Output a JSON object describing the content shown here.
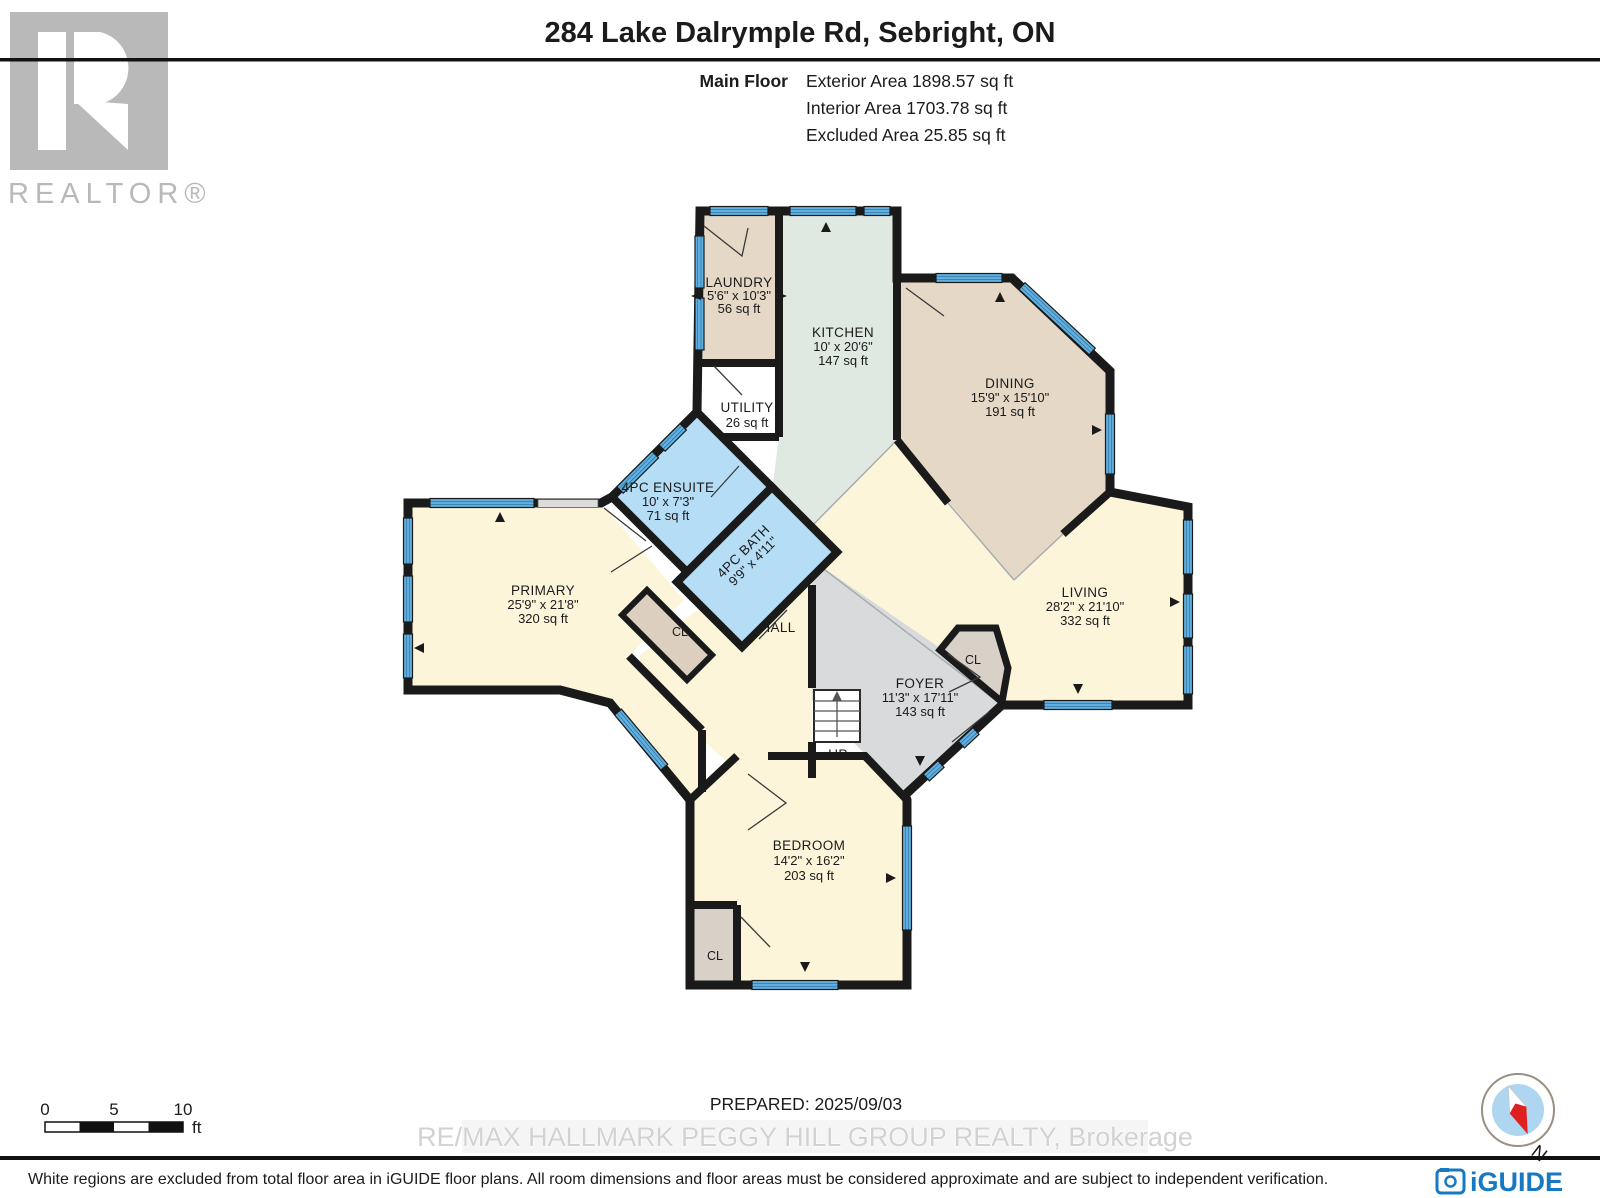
{
  "header": {
    "title": "284 Lake Dalrymple Rd, Sebright, ON",
    "floor_label": "Main Floor",
    "exterior_area": "Exterior Area 1898.57 sq ft",
    "interior_area": "Interior Area 1703.78 sq ft",
    "excluded_area": "Excluded Area 25.85 sq ft"
  },
  "branding": {
    "realtor_logo_letter": "R",
    "realtor_logo_text": "REALTOR®",
    "iguide_logo_text": "iGUIDE",
    "compass_north_label": "N"
  },
  "plan": {
    "palette": {
      "wall": "#1a1a1a",
      "cream": "#fdf5da",
      "tan": "#e5d8c6",
      "mint": "#dfe9e2",
      "bath_blue": "#b5ddf5",
      "foyer_gray": "#d9dadb",
      "closet_tan": "#dccfc0",
      "closet_gray": "#d7d1c8",
      "white": "#ffffff",
      "window_blue": "#55a9db",
      "window_dark": "#1c4f73",
      "compass_blue": "#aed6f1",
      "compass_red": "#e02020"
    },
    "rooms": [
      {
        "name": "LAUNDRY",
        "dims": "5'6\" x 10'3\"",
        "area": "56 sq ft"
      },
      {
        "name": "KITCHEN",
        "dims": "10' x 20'6\"",
        "area": "147 sq ft"
      },
      {
        "name": "DINING",
        "dims": "15'9\" x 15'10\"",
        "area": "191 sq ft"
      },
      {
        "name": "UTILITY",
        "area": "26 sq ft"
      },
      {
        "name": "4PC ENSUITE",
        "dims": "10' x 7'3\"",
        "area": "71 sq ft"
      },
      {
        "name": "4PC BATH",
        "dims": "9'9\" x 4'11\""
      },
      {
        "name": "PRIMARY",
        "dims": "25'9\" x 21'8\"",
        "area": "320 sq ft"
      },
      {
        "name": "HALL"
      },
      {
        "name": "FOYER",
        "dims": "11'3\" x 17'11\"",
        "area": "143 sq ft"
      },
      {
        "name": "LIVING",
        "dims": "28'2\" x 21'10\"",
        "area": "332 sq ft"
      },
      {
        "name": "BEDROOM",
        "dims": "14'2\" x 16'2\"",
        "area": "203 sq ft"
      },
      {
        "name": "CL"
      },
      {
        "name": "CL"
      },
      {
        "name": "CL"
      },
      {
        "name": "UP"
      }
    ]
  },
  "scale_bar": {
    "tick_0": "0",
    "tick_5": "5",
    "tick_10": "10",
    "unit": "ft"
  },
  "footer": {
    "prepared": "PREPARED: 2025/09/03",
    "watermark": "RE/MAX HALLMARK PEGGY HILL GROUP REALTY, Brokerage",
    "disclaimer": "White regions are excluded from total floor area in iGUIDE floor plans. All room dimensions and floor areas must be considered approximate and are subject to independent verification."
  }
}
